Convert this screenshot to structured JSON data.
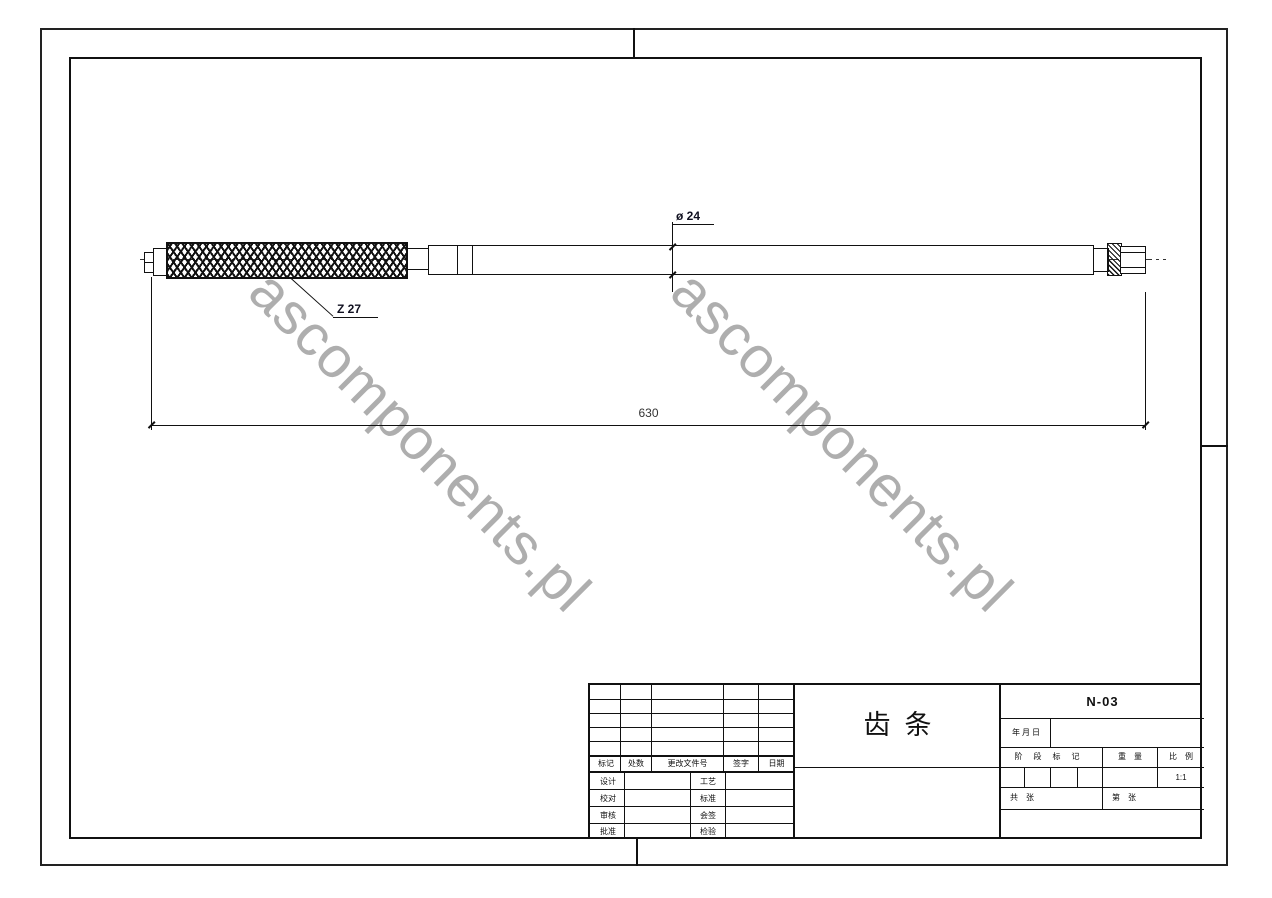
{
  "drawing": {
    "dimensions": {
      "diameter_label": "ø 24",
      "teeth_label": "Z 27",
      "length_label": "630"
    },
    "watermark_text": "ascomponents.pl"
  },
  "title_block": {
    "part_name": "齿条",
    "drawing_number": "N-03",
    "date_label": "年 月 日",
    "revision_header": {
      "c0": "标记",
      "c1": "处数",
      "c2": "更改文件号",
      "c3": "签字",
      "c4": "日期"
    },
    "signature_rows": {
      "r0": {
        "left": "设计",
        "right": "工艺"
      },
      "r1": {
        "left": "校对",
        "right": "标准"
      },
      "r2": {
        "left": "审核",
        "right": "会签"
      },
      "r3": {
        "left": "批准",
        "right": "检验"
      }
    },
    "stage_mark_label": "阶段标记",
    "weight_label": "重量",
    "scale_label": "比例",
    "scale_value": "1:1",
    "sheets_total_label": "共　张",
    "sheet_no_label": "第　张"
  }
}
